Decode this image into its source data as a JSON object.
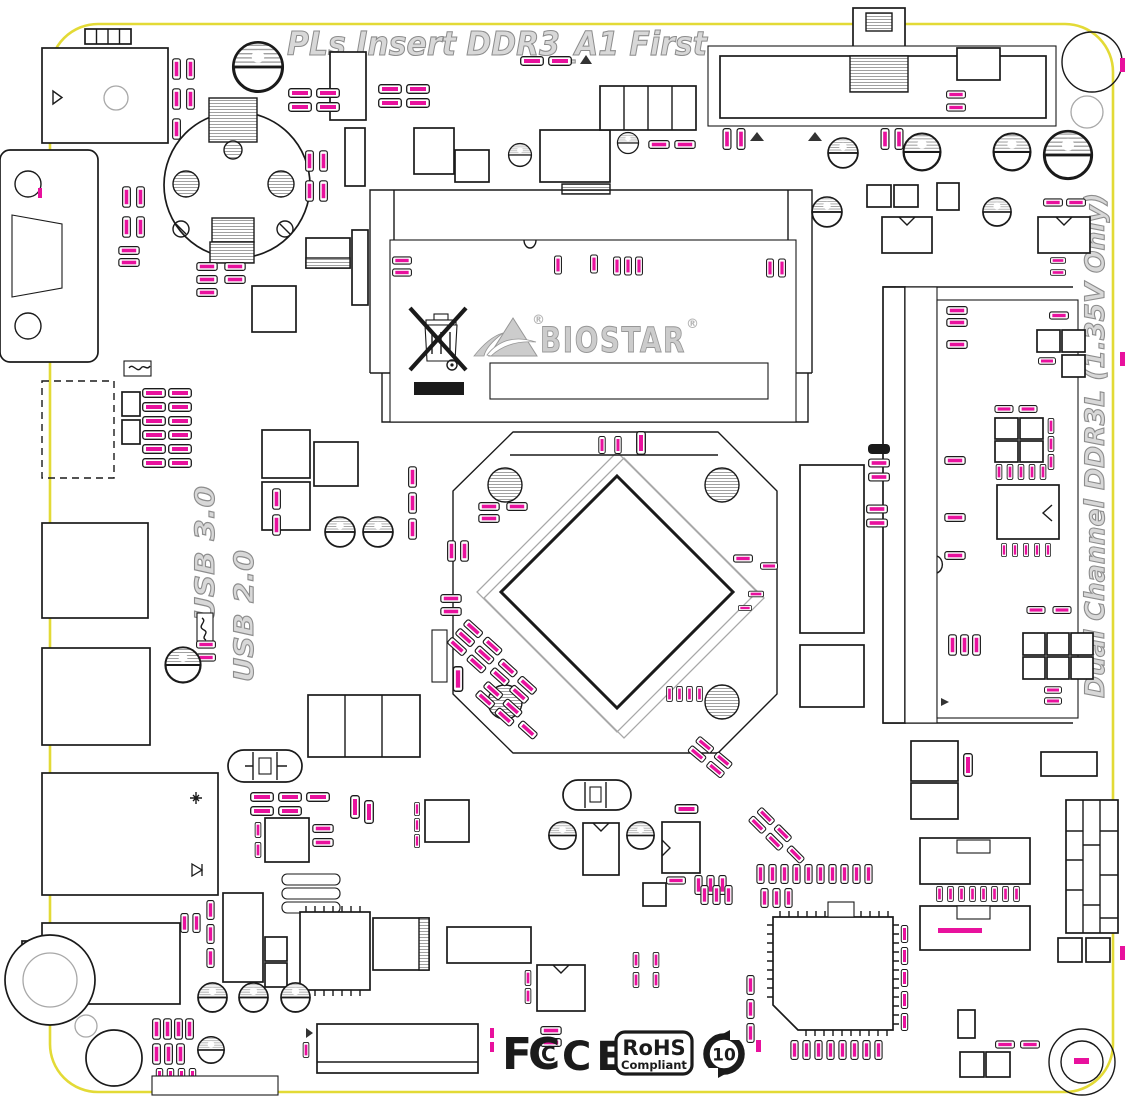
{
  "notes": {
    "insert_first": "PLs Insert DDR3_A1 First",
    "dual_channel": "Dual Channel DDR3L (1.35V Only)",
    "usb3": "USB 3.0",
    "usb2": "USB 2.0"
  },
  "brand": {
    "name": "BIOSTAR",
    "reg_mark": "®"
  },
  "certifications": {
    "fcc_letter_f": "F",
    "fcc_letter_c_outer": "C",
    "fcc_letter_c_inner": "C",
    "ce": "CE",
    "rohs_title": "RoHS",
    "rohs_subtitle": "Compliant",
    "china_rohs_years": "10"
  },
  "colors": {
    "board_edge_yellow": "#e3da36",
    "silkscreen_black": "#1a1a1a",
    "component_label_magenta": "#e8119d",
    "note_gray_fill": "#d8d8d8",
    "note_gray_outline": "#8d8d8d",
    "hatch_gray": "#a0a0a0"
  }
}
